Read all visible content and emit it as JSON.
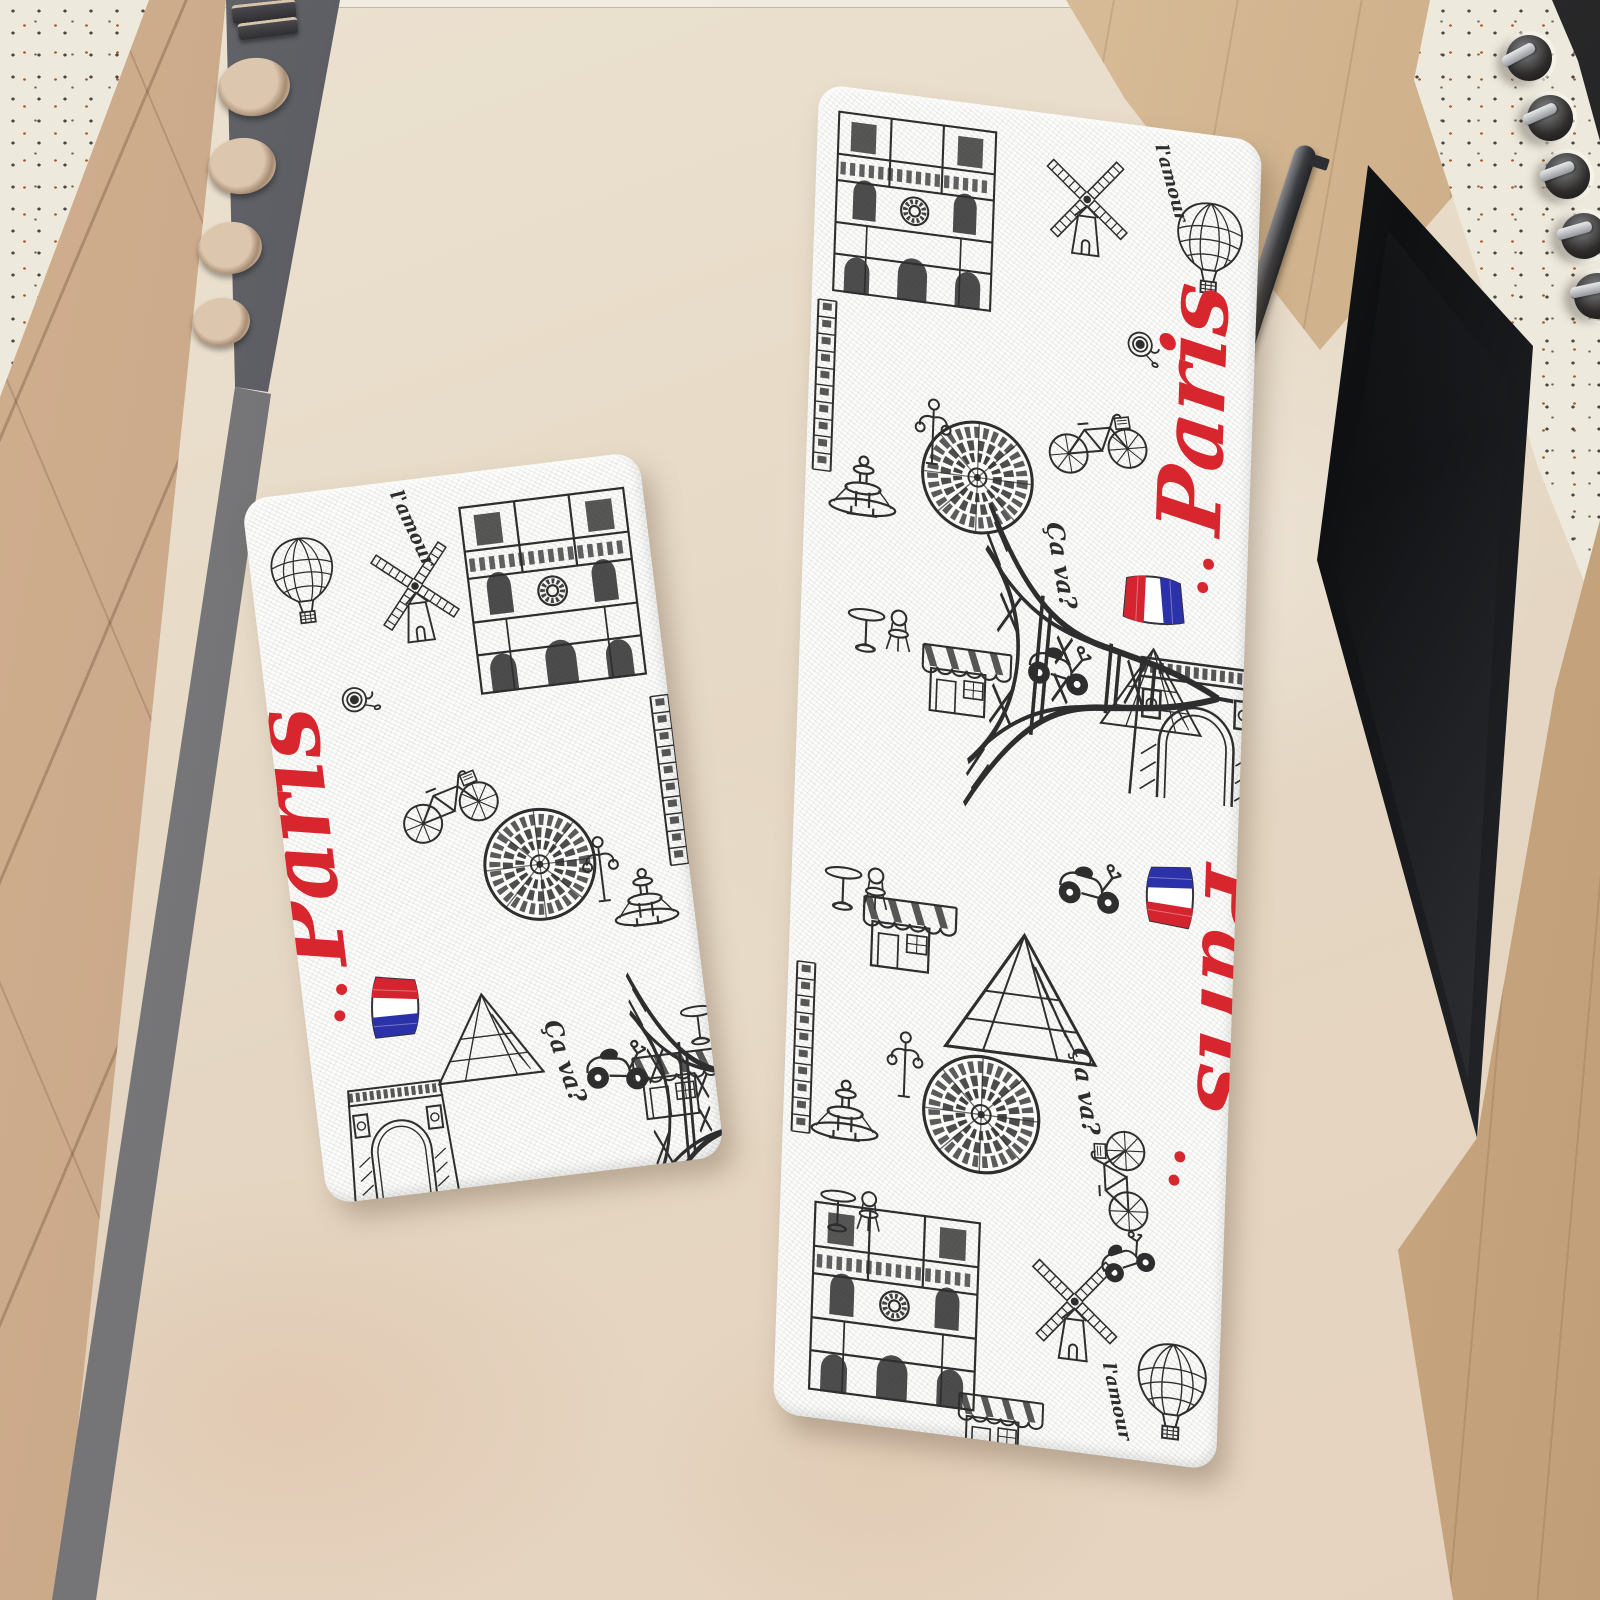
{
  "image": {
    "type": "product photograph",
    "subject": "Two-piece Paris doodle print kitchen mat set on a kitchen floor between cabinets and an oven"
  },
  "mats": {
    "words": {
      "paris": "Paris",
      "ca_va": "Ça va?",
      "l_amour": "l'amour"
    },
    "motifs": [
      "Eiffel Tower",
      "Notre-Dame cathedral",
      "Arc de Triomphe",
      "Moulin Rouge windmill",
      "hot-air balloon",
      "bicycle",
      "scooter",
      "café awning",
      "bistro table and chairs",
      "Louvre pyramid",
      "rose window",
      "fountain",
      "street lamp",
      "French flag",
      "coffee cup",
      "red ellipsis dots"
    ],
    "left_mat": {
      "shape": "small rectangle mat",
      "print": "black and white Paris doodles with red Paris script and French flags"
    },
    "runner_mat": {
      "shape": "long runner mat",
      "print": "same Paris doodle pattern repeated twice, one copy upside down"
    }
  },
  "kitchen": {
    "floor": "beige stone floor",
    "left": "tan cabinet fronts with gray toe kick and open drawer holding bowls",
    "top_left": "terrazzo countertop corner",
    "top_right": "terrazzo counter edge with control knobs",
    "knob_count": 5,
    "right": "built-in oven with dark glass door and metal handle, wood panels"
  },
  "palette": {
    "floor": "#e6d8c4",
    "cabinet_wood": "#c4a385",
    "toe_kick": "#6b6b6d",
    "drawer": "#515257",
    "bowl": "#c9b098",
    "terrazzo": "#edeadd",
    "wood_panel": "#d6ba95",
    "oven_black": "#141416",
    "mat_white": "#fcfcfa",
    "ink": "#2e2e2e",
    "accent_red": "#d8262e",
    "accent_blue": "#2b31a8"
  }
}
